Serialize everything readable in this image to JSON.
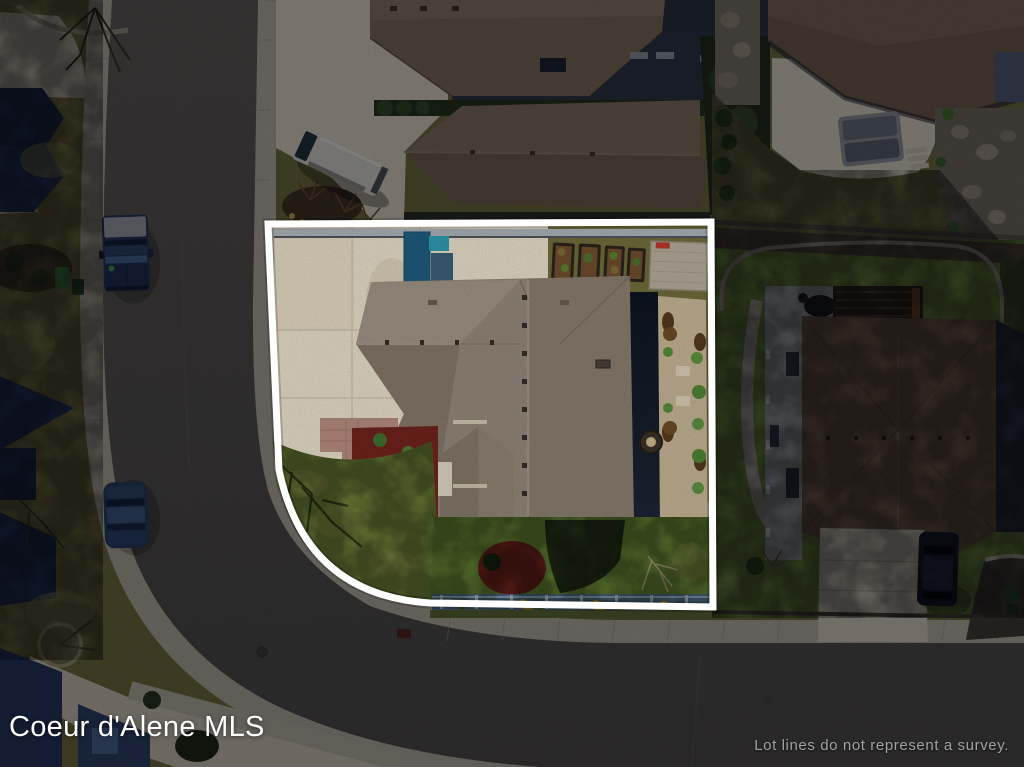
{
  "image": {
    "kind": "aerial drone photograph of a residential property with MLS lot-line overlay",
    "width_px": 1024,
    "height_px": 767
  },
  "watermark": {
    "label": "Coeur d'Alene MLS",
    "color": "#ffffff"
  },
  "disclaimer": {
    "label": "Lot lines do not represent a survey.",
    "color": "#a2a2a2"
  },
  "lot": {
    "outline_color": "#ffffff",
    "outline_width_px": 7,
    "outside_dim_opacity": 0.4
  },
  "palette": {
    "road": "#55524d",
    "sidewalk": "#b7b1a1",
    "driveway_concrete": "#e0d8c4",
    "subject_roof": "#918577",
    "subject_front_lawn": "#7d9140",
    "subject_back_lawn": "#6c8c38",
    "outside_grass": "#6e6b3a",
    "neighbor_roof_right": "#705845",
    "neighbor_roof_top": "#7d6c57",
    "shadowed_roofs_left": "#23355c",
    "red_mulch": "#6e231c",
    "blue_gate": "#1f5a7d",
    "bottom_fence": "#587a95",
    "yellow_flowers": "#d7bc2c"
  },
  "scene": {
    "features": [
      "subject corner lot outlined in white",
      "L-curved residential street with sidewalks",
      "subject house with complex hip roof and large concrete driveway",
      "raised garden beds and storage shed along back fence",
      "blue gate and shade structure on driveway",
      "red mulch planting beds and paver entry walk",
      "backyard fence with yellow flowers along street side",
      "right neighbor two-story home with covered porch and pergola",
      "upper neighbors with brown shingle roofs",
      "white van parked in neighbor driveway",
      "dark pickup truck parked on street",
      "dark sedan parked on street",
      "dark SUV in right neighbor driveway"
    ]
  }
}
